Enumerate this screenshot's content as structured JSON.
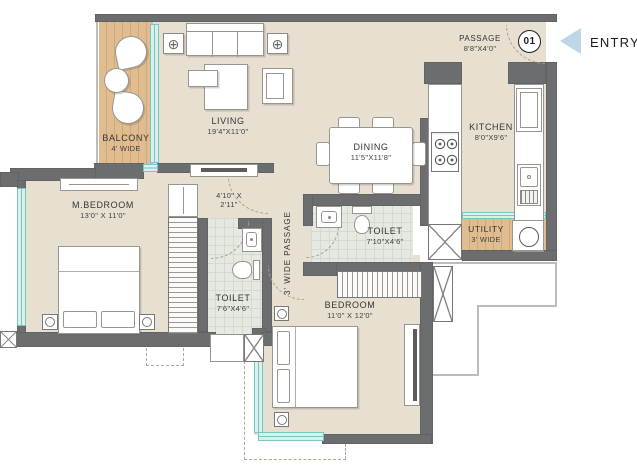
{
  "type": "floor-plan",
  "entry": {
    "label": "ENTRY",
    "door_number": "01"
  },
  "rooms": {
    "balcony": {
      "name": "BALCONY",
      "dims": "4' WIDE"
    },
    "living": {
      "name": "LIVING",
      "dims": "19'4\"X11'0\""
    },
    "dining": {
      "name": "DINING",
      "dims": "11'5\"X11'8\""
    },
    "kitchen": {
      "name": "KITCHEN",
      "dims": "8'0\"X9'6\""
    },
    "passage": {
      "name": "PASSAGE",
      "dims": "8'8\"X4'0\""
    },
    "master_bedroom": {
      "name": "M.BEDROOM",
      "dims": "13'0\" X 11'0\""
    },
    "lobby": {
      "dims_line1": "4'10\" X",
      "dims_line2": "2'11\""
    },
    "wide_passage": {
      "name": "3' WIDE PASSAGE"
    },
    "master_toilet": {
      "name": "TOILET",
      "dims": "7'6\"X4'6\""
    },
    "common_toilet": {
      "name": "TOILET",
      "dims": "7'10\"X4'6\""
    },
    "utility": {
      "name": "UTILITY",
      "dims": "3' WIDE"
    },
    "bedroom": {
      "name": "BEDROOM",
      "dims": "11'0\" X 12'0\""
    }
  },
  "colors": {
    "floor_beige": "#e7e0d1",
    "wood": "#dfbd92",
    "wall": "#6c6d6f",
    "window_teal": "#7cc5bf",
    "toilet_tile": "#e5e9e2",
    "entry_triangle": "#bdd7e9",
    "text": "#3b3c3e"
  }
}
